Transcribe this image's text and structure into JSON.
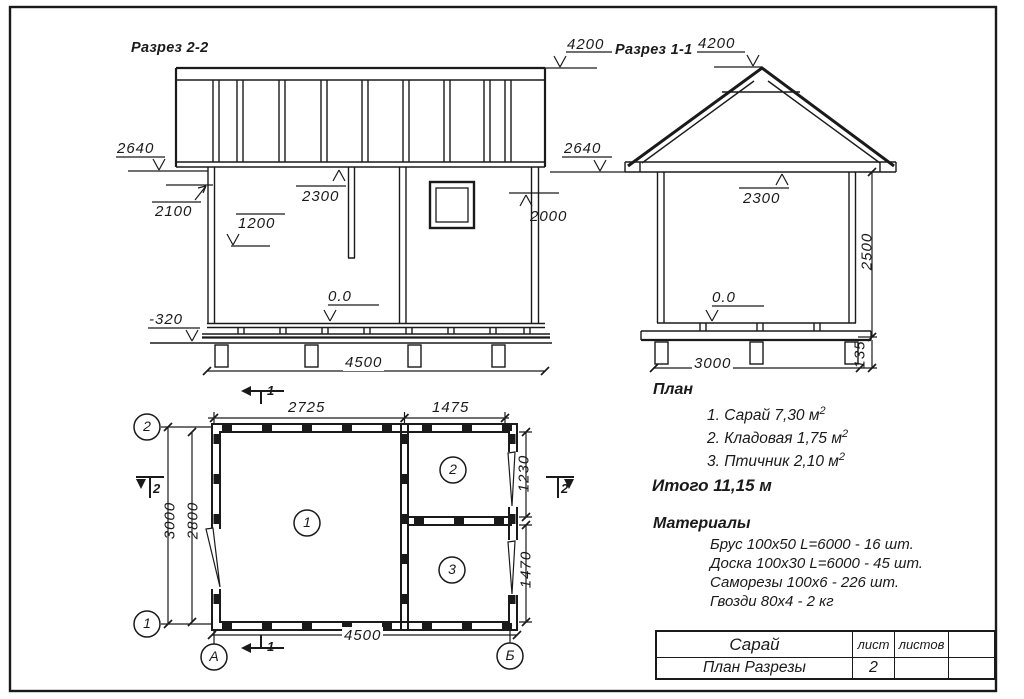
{
  "section22": {
    "title": "Разрез 2-2",
    "dim_roof_top": "4200",
    "dim_eaves": "2640",
    "dim_door_height": "2100",
    "dim_shelf": "1200",
    "dim_ceiling": "2300",
    "dim_right_opening": "2000",
    "level_floor": "0.0",
    "level_ground": "-320",
    "dim_width": "4500"
  },
  "section11": {
    "title": "Разрез 1-1",
    "dim_roof_top": "4200",
    "dim_eaves": "2640",
    "dim_ceiling": "2300",
    "dim_wall_height": "2500",
    "level_floor": "0.0",
    "dim_width": "3000",
    "dim_base": "135"
  },
  "plan": {
    "dim_room1_width": "2725",
    "dim_room23_width": "1475",
    "dim_axis_height": "3000",
    "dim_inner_height": "2800",
    "dim_room2_height": "1230",
    "dim_room3_height": "1470",
    "dim_total_width": "4500",
    "room_numbers": [
      "1",
      "2",
      "3"
    ],
    "axis_top": "2",
    "axis_bottom": "1",
    "axis_left": "А",
    "axis_right": "Б",
    "section_mark_1": "1",
    "section_mark_2": "2"
  },
  "notes": {
    "plan_title": "План",
    "items": [
      {
        "text": "1. Сарай 7,30 м",
        "sup": "2"
      },
      {
        "text": "2. Кладовая 1,75 м",
        "sup": "2"
      },
      {
        "text": "3. Птичник 2,10 м",
        "sup": "2"
      }
    ],
    "total": "Итого 11,15 м",
    "materials_title": "Материалы",
    "materials": [
      "Брус 100х50 L=6000 - 16 шт.",
      "Доска 100х30 L=6000 - 45 шт.",
      "Саморезы 100х6 - 226 шт.",
      "Гвозди 80х4 - 2 кг"
    ]
  },
  "title_block": {
    "name": "Сарай",
    "doc": "План Разрезы",
    "sheet_label": "лист",
    "sheets_label": "листов",
    "sheet_number": "2"
  }
}
